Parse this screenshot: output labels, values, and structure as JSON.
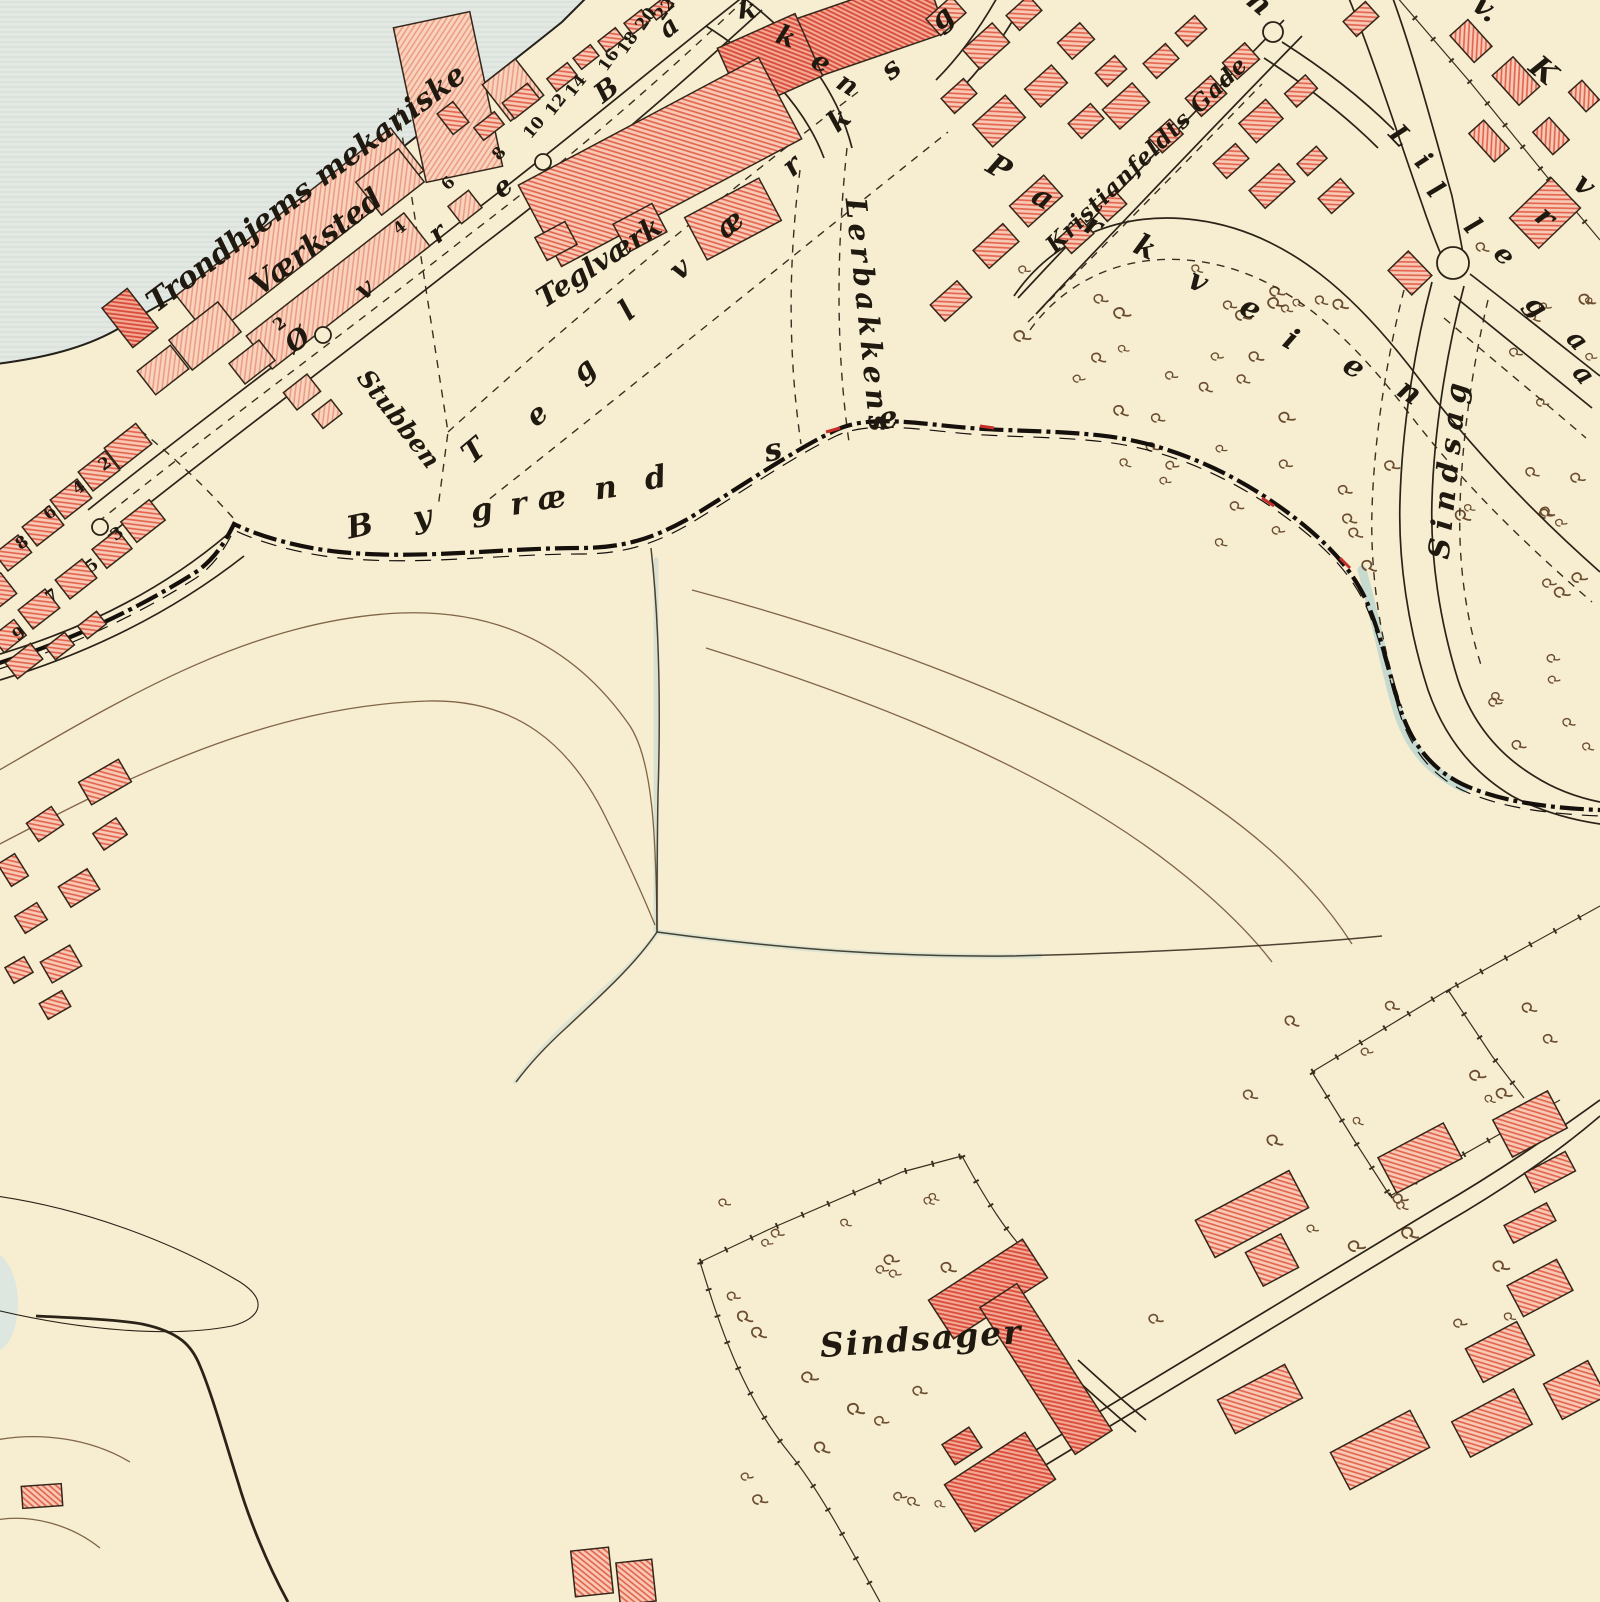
{
  "map": {
    "colors": {
      "paper": "#f7eed2",
      "water": "#e3e8e3",
      "water_stripe": "#d2dcd8",
      "ink": "#2b2317",
      "building_fill": "#f8cdb9",
      "building_hatch": "#e06a54",
      "building_fill_salmon": "#f9d3bd",
      "building_hatch_salmon": "#ea9b82",
      "building_fill_dark": "#f3a995",
      "building_hatch_dark": "#d84a38",
      "contour_brown": "#6b4c2e",
      "stream_blue": "#b9d4cf",
      "boundary_black": "#15100b",
      "accent_red": "#c62f2a"
    },
    "labels": [
      {
        "text": "Trondhjems mekaniske",
        "x": 312,
        "y": 196,
        "rot": -37,
        "size": 30
      },
      {
        "text": "Værksted",
        "x": 322,
        "y": 250,
        "rot": -37,
        "size": 30
      },
      {
        "text": "Teglværk",
        "x": 604,
        "y": 270,
        "rot": -33,
        "size": 28
      },
      {
        "text": "Stubben",
        "x": 392,
        "y": 424,
        "rot": 52,
        "size": 25
      },
      {
        "text": "Kristianfeldts Gade",
        "x": 1152,
        "y": 160,
        "rot": -44,
        "size": 23,
        "ls": 1
      },
      {
        "text": "Lerbakkens",
        "x": 858,
        "y": 318,
        "rot": 84,
        "size": 29,
        "ls": 5
      },
      {
        "text": "Sindsag",
        "x": 1458,
        "y": 468,
        "rot": -84,
        "size": 29,
        "ls": 8
      },
      {
        "text": "Sindsager",
        "x": 922,
        "y": 1350,
        "rot": -4,
        "size": 33,
        "ls": 2
      }
    ],
    "letter_runs": [
      {
        "name": "bygraendse",
        "size": 31,
        "letters": [
          [
            "B",
            362,
            536,
            -12
          ],
          [
            "y",
            424,
            527,
            -10
          ],
          [
            "g",
            483,
            520,
            -8
          ],
          [
            "r",
            520,
            514,
            -8
          ],
          [
            "æ",
            553,
            508,
            -8
          ],
          [
            "n",
            607,
            498,
            -8
          ],
          [
            "d",
            657,
            488,
            -10
          ],
          [
            "s",
            775,
            460,
            -12
          ],
          [
            "e",
            890,
            428,
            -12
          ]
        ]
      },
      {
        "name": "ovre-bakkens-gade",
        "size": 27,
        "letters": [
          [
            "Ø",
            303,
            347,
            -38
          ],
          [
            "v",
            370,
            296,
            -38
          ],
          [
            "r",
            443,
            240,
            -38
          ],
          [
            "e",
            508,
            194,
            -38
          ],
          [
            "B",
            612,
            97,
            -38
          ],
          [
            "a",
            674,
            34,
            -38
          ],
          [
            "k",
            748,
            18,
            -5
          ],
          [
            "k",
            783,
            45,
            20
          ],
          [
            "e",
            817,
            70,
            28
          ],
          [
            "n",
            843,
            92,
            32
          ]
        ]
      },
      {
        "name": "teglvaerksgade",
        "size": 29,
        "letters": [
          [
            "T",
            480,
            458,
            -40
          ],
          [
            "e",
            543,
            422,
            -40
          ],
          [
            "g",
            590,
            377,
            -40
          ],
          [
            "l",
            633,
            318,
            -40
          ],
          [
            "v",
            686,
            276,
            -40
          ],
          [
            "æ",
            736,
            231,
            -40
          ],
          [
            "r",
            798,
            173,
            -40
          ],
          [
            "k",
            845,
            127,
            -40
          ],
          [
            "s",
            897,
            76,
            -40
          ],
          [
            "g",
            948,
            25,
            -40
          ]
        ]
      },
      {
        "name": "parkveien",
        "size": 30,
        "letters": [
          [
            "P",
            994,
            176,
            30
          ],
          [
            "a",
            1038,
            206,
            30
          ],
          [
            "r",
            1089,
            234,
            28
          ],
          [
            "k",
            1141,
            256,
            25
          ],
          [
            "v",
            1194,
            290,
            26
          ],
          [
            "e",
            1246,
            317,
            28
          ],
          [
            "i",
            1286,
            348,
            30
          ],
          [
            "e",
            1349,
            375,
            32
          ],
          [
            "n",
            1404,
            400,
            34
          ]
        ]
      },
      {
        "name": "lillegaden",
        "size": 27,
        "letters": [
          [
            "L",
            1394,
            142,
            46
          ],
          [
            "i",
            1417,
            167,
            46
          ],
          [
            "l",
            1429,
            196,
            48
          ],
          [
            "l",
            1466,
            232,
            48
          ],
          [
            "e",
            1498,
            261,
            48
          ],
          [
            "g",
            1530,
            312,
            48
          ],
          [
            "a",
            1571,
            346,
            48
          ],
          [
            "a",
            1577,
            380,
            50
          ]
        ]
      },
      {
        "name": "edge-fragments",
        "size": 30,
        "letters": [
          [
            "n",
            1253,
            10,
            40
          ],
          [
            "v.",
            1480,
            16,
            40
          ],
          [
            "K",
            1537,
            78,
            40
          ],
          [
            "r",
            1539,
            224,
            42
          ],
          [
            "v",
            1578,
            192,
            42
          ]
        ]
      }
    ],
    "house_numbers": [
      [
        2,
        283,
        328,
        -38
      ],
      [
        4,
        403,
        232,
        -38
      ],
      [
        6,
        452,
        187,
        -45
      ],
      [
        8,
        503,
        157,
        -48
      ],
      [
        10,
        538,
        131,
        -50
      ],
      [
        12,
        560,
        108,
        -52
      ],
      [
        14,
        580,
        89,
        -52
      ],
      [
        16,
        613,
        63,
        -55
      ],
      [
        18,
        632,
        46,
        -55
      ],
      [
        20,
        650,
        22,
        -55
      ],
      [
        22,
        669,
        12,
        -55
      ],
      [
        2,
        108,
        468,
        -36
      ],
      [
        4,
        82,
        492,
        -36
      ],
      [
        6,
        53,
        517,
        -36
      ],
      [
        8,
        25,
        547,
        -36
      ],
      [
        3,
        120,
        538,
        -36
      ],
      [
        5,
        95,
        570,
        -36
      ],
      [
        7,
        55,
        600,
        -36
      ],
      [
        9,
        22,
        638,
        -36
      ]
    ]
  }
}
